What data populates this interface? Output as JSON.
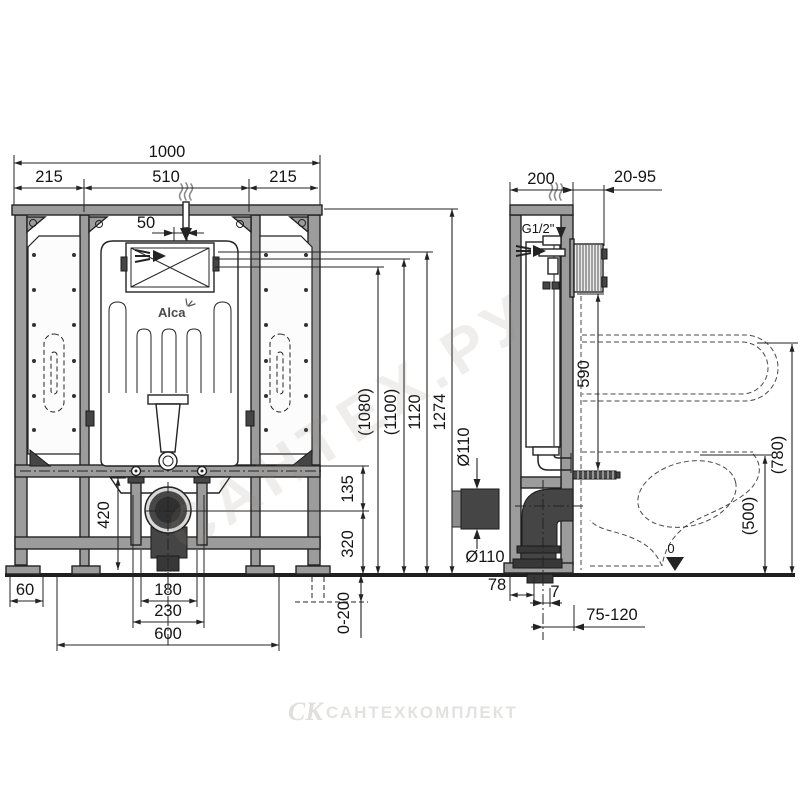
{
  "drawing_type": "installation frame for wall-hung WC, front and side projection",
  "colors": {
    "line": "#232323",
    "frame_fill": "#9c9c9c",
    "dark_part": "#454545",
    "paper": "#ffffff"
  },
  "logo": {
    "brand": "Alca"
  },
  "front_view": {
    "dims": {
      "total_width": "1000",
      "left_span": "215",
      "center_span": "510",
      "right_span": "215",
      "inlet_offset": "50",
      "height_1080": "(1080)",
      "height_1100": "(1100)",
      "height_1120": "1120",
      "height_1274": "1274",
      "bracket_to_axis": "135",
      "axis_to_floor": "320",
      "lower_frame": "420",
      "foot_width": "60",
      "stud_spacing": "180",
      "bracket_width": "230",
      "base_width": "600",
      "leg_adjust_range": "0-200"
    }
  },
  "side_view": {
    "dims": {
      "frame_depth": "200",
      "wall_finish_range": "20-95",
      "water_connection": "G1/2\"",
      "box_to_bracket": "590",
      "outlet_diameter_top": "Ø110",
      "outlet_diameter_bottom": "Ø110",
      "bowl_top_height": "(780)",
      "seat_height": "(500)",
      "floor_level": "0",
      "wall_to_pipe": "78",
      "pipe_offset": "7",
      "drain_axis_range": "75-120"
    }
  },
  "watermark": {
    "diagonal": "САНТЕХ.РУ",
    "logo": "СК",
    "name": "САНТЕХКОМПЛЕКТ"
  }
}
